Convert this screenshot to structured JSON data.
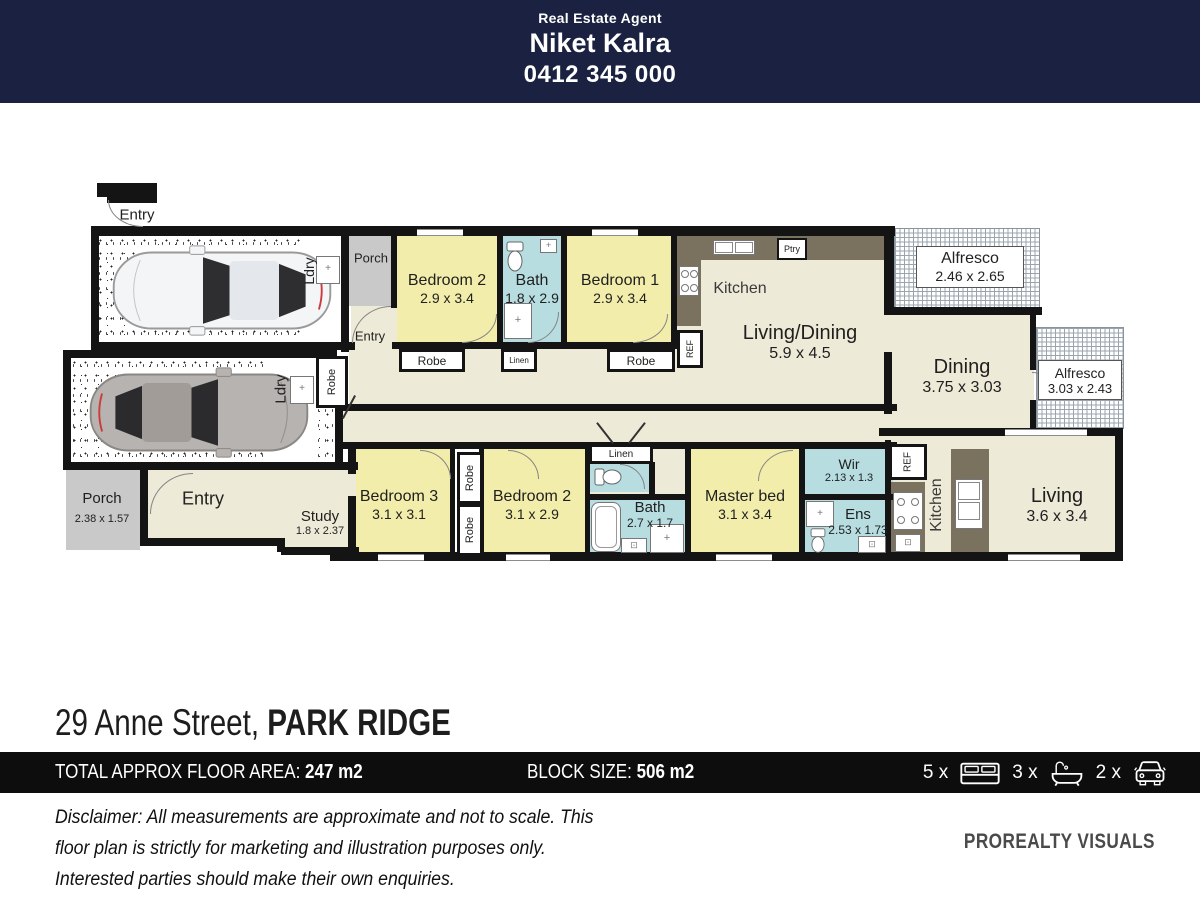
{
  "header": {
    "tagline": "Real Estate Agent",
    "agent_name": "Niket Kalra",
    "phone": "0412 345 000"
  },
  "address": {
    "street": "29 Anne Street, ",
    "suburb": "PARK RIDGE"
  },
  "info_bar": {
    "floor_area_label": "TOTAL APPROX FLOOR AREA: ",
    "floor_area_value": "247 m2",
    "block_label": "BLOCK SIZE: ",
    "block_value": "506 m2",
    "beds_count": "5 x",
    "baths_count": "3 x",
    "cars_count": "2 x"
  },
  "disclaimer": "Disclaimer: All measurements are approximate and not to scale. This floor plan is strictly for marketing and illustration purposes only. Interested parties should make their own enquiries.",
  "branding": "PROREALTY VISUALS",
  "plan": {
    "rooms": [
      {
        "name": "Bedroom 2",
        "dims": "2.9 x 3.4"
      },
      {
        "name": "Bath",
        "dims": "1.8 x 2.9"
      },
      {
        "name": "Bedroom 1",
        "dims": "2.9 x 3.4"
      },
      {
        "name": "Kitchen",
        "dims": ""
      },
      {
        "name": "Living/Dining",
        "dims": "5.9 x 4.5"
      },
      {
        "name": "Alfresco",
        "dims": "2.46 x 2.65"
      },
      {
        "name": "Dining",
        "dims": "3.75 x 3.03"
      },
      {
        "name": "Alfresco",
        "dims": "3.03 x 2.43"
      },
      {
        "name": "Living",
        "dims": "3.6 x 3.4"
      },
      {
        "name": "Bedroom 3",
        "dims": "3.1 x 3.1"
      },
      {
        "name": "Bedroom 2",
        "dims": "3.1 x 2.9"
      },
      {
        "name": "Bath",
        "dims": "2.7 x 1.7"
      },
      {
        "name": "Master bed",
        "dims": "3.1 x 3.4"
      },
      {
        "name": "Wir",
        "dims": "2.13 x 1.3"
      },
      {
        "name": "Ens",
        "dims": "2.53 x 1.73"
      },
      {
        "name": "Kitchen",
        "dims": ""
      },
      {
        "name": "Porch",
        "dims": "2.38 x 1.57"
      },
      {
        "name": "Study",
        "dims": "1.8 x 2.37"
      },
      {
        "name": "Porch",
        "dims": ""
      }
    ],
    "labels": {
      "entry_garage": "Entry",
      "ldry_a": "Ldry",
      "entry_a": "Entry",
      "robe_nook": "Robe",
      "ldry_b": "Ldry",
      "entry_b": "Entry",
      "robe_box_1": "Robe",
      "linen_a": "Linen",
      "robe_box_2": "Robe",
      "ref_a": "REF",
      "ptry": "Ptry",
      "robe_col_top": "Robe",
      "robe_col_bottom": "Robe",
      "linen_b": "Linen",
      "ref_b": "REF"
    }
  }
}
